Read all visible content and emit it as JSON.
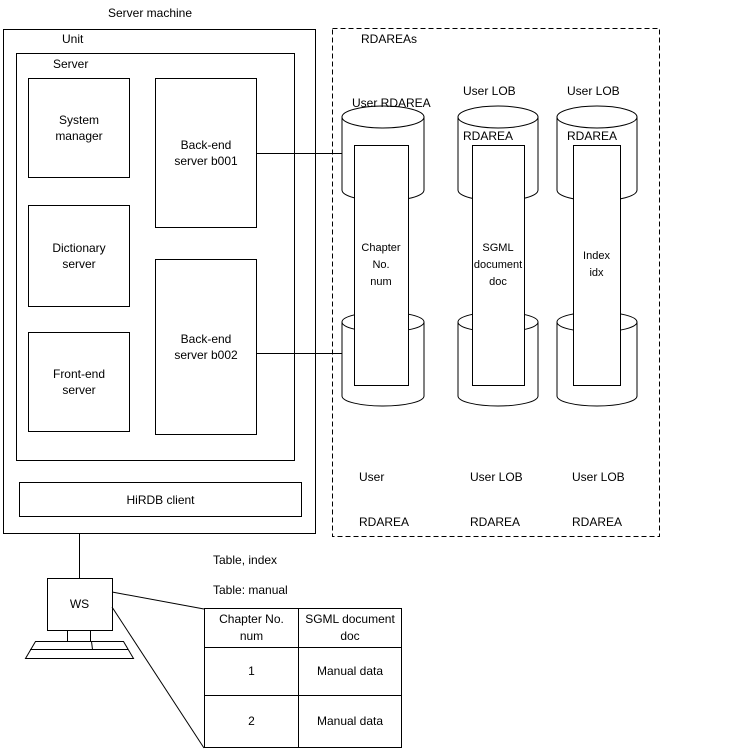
{
  "title": "Server machine",
  "machine": {
    "unit_label": "Unit",
    "server_label": "Server",
    "system_manager": {
      "line1": "System",
      "line2": "manager"
    },
    "dictionary_server": {
      "line1": "Dictionary",
      "line2": "server"
    },
    "front_end_server": {
      "line1": "Front-end",
      "line2": "server"
    },
    "back_end_server_1": {
      "line1": "Back-end",
      "line2": "server b001"
    },
    "back_end_server_2": {
      "line1": "Back-end",
      "line2": "server b002"
    },
    "hirdb_client_label": "HiRDB client"
  },
  "rdareas": {
    "box_label": "RDAREAs",
    "columns": [
      {
        "top_label": {
          "line1": "User RDAREA",
          "line2": ""
        },
        "content": {
          "line1": "Chapter",
          "line2": "No.",
          "line3": "num"
        },
        "bottom_label": {
          "line1": "User",
          "line2": "RDAREA"
        }
      },
      {
        "top_label": {
          "line1": "User LOB",
          "line2": "RDAREA"
        },
        "content": {
          "line1": "SGML",
          "line2": "document",
          "line3": "doc"
        },
        "bottom_label": {
          "line1": "User LOB",
          "line2": "RDAREA"
        }
      },
      {
        "top_label": {
          "line1": "User LOB",
          "line2": "RDAREA"
        },
        "content": {
          "line1": "Index",
          "line2": "idx",
          "line3": ""
        },
        "bottom_label": {
          "line1": "User LOB",
          "line2": "RDAREA"
        }
      }
    ]
  },
  "workstation": {
    "label": "WS"
  },
  "table_section": {
    "caption_line1": "Table, index",
    "caption_line2": "Table: manual",
    "table": {
      "headers": [
        {
          "line1": "Chapter No.",
          "line2": "num"
        },
        {
          "line1": "SGML document",
          "line2": "doc"
        }
      ],
      "rows": [
        {
          "col1": "1",
          "col2": "Manual data"
        },
        {
          "col1": "2",
          "col2": "Manual data"
        }
      ]
    }
  }
}
